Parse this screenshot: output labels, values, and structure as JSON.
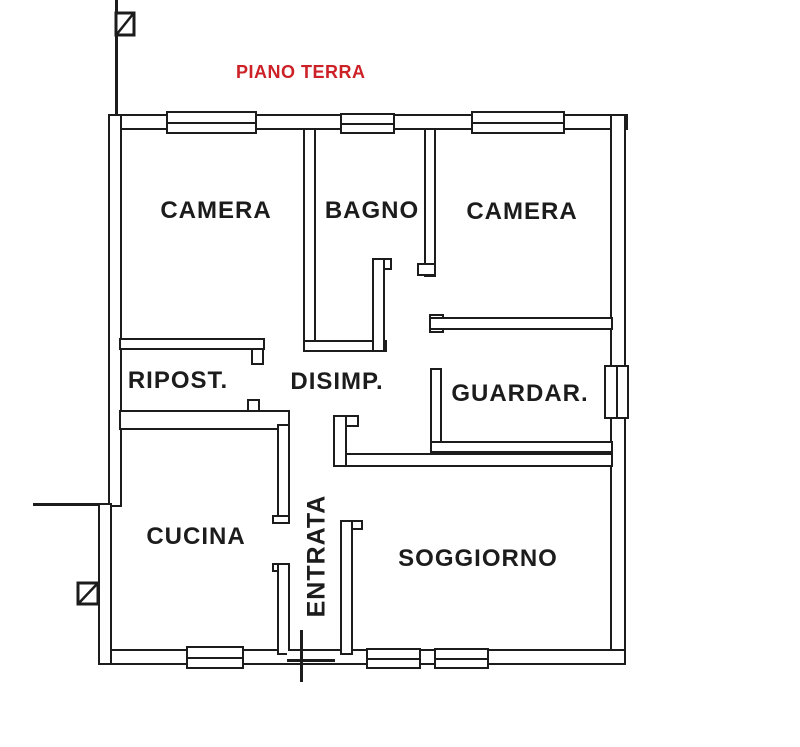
{
  "title": {
    "text": "PIANO TERRA",
    "color": "#cc2127"
  },
  "theme": {
    "line_color": "#1c1c1c",
    "background": "#ffffff"
  },
  "rooms": [
    {
      "id": "camera-left",
      "label": "CAMERA"
    },
    {
      "id": "bagno",
      "label": "BAGNO"
    },
    {
      "id": "camera-right",
      "label": "CAMERA"
    },
    {
      "id": "ripostiglio",
      "label": "RIPOST."
    },
    {
      "id": "disimpegno",
      "label": "DISIMP."
    },
    {
      "id": "guardaroba",
      "label": "GUARDAR."
    },
    {
      "id": "cucina",
      "label": "CUCINA"
    },
    {
      "id": "entrata",
      "label": "ENTRATA"
    },
    {
      "id": "soggiorno",
      "label": "SOGGIORNO"
    }
  ],
  "symbols": {
    "window": "double-line window opening",
    "boundary_post": "square post with diagonal",
    "entrance_door": "door threshold tick"
  }
}
